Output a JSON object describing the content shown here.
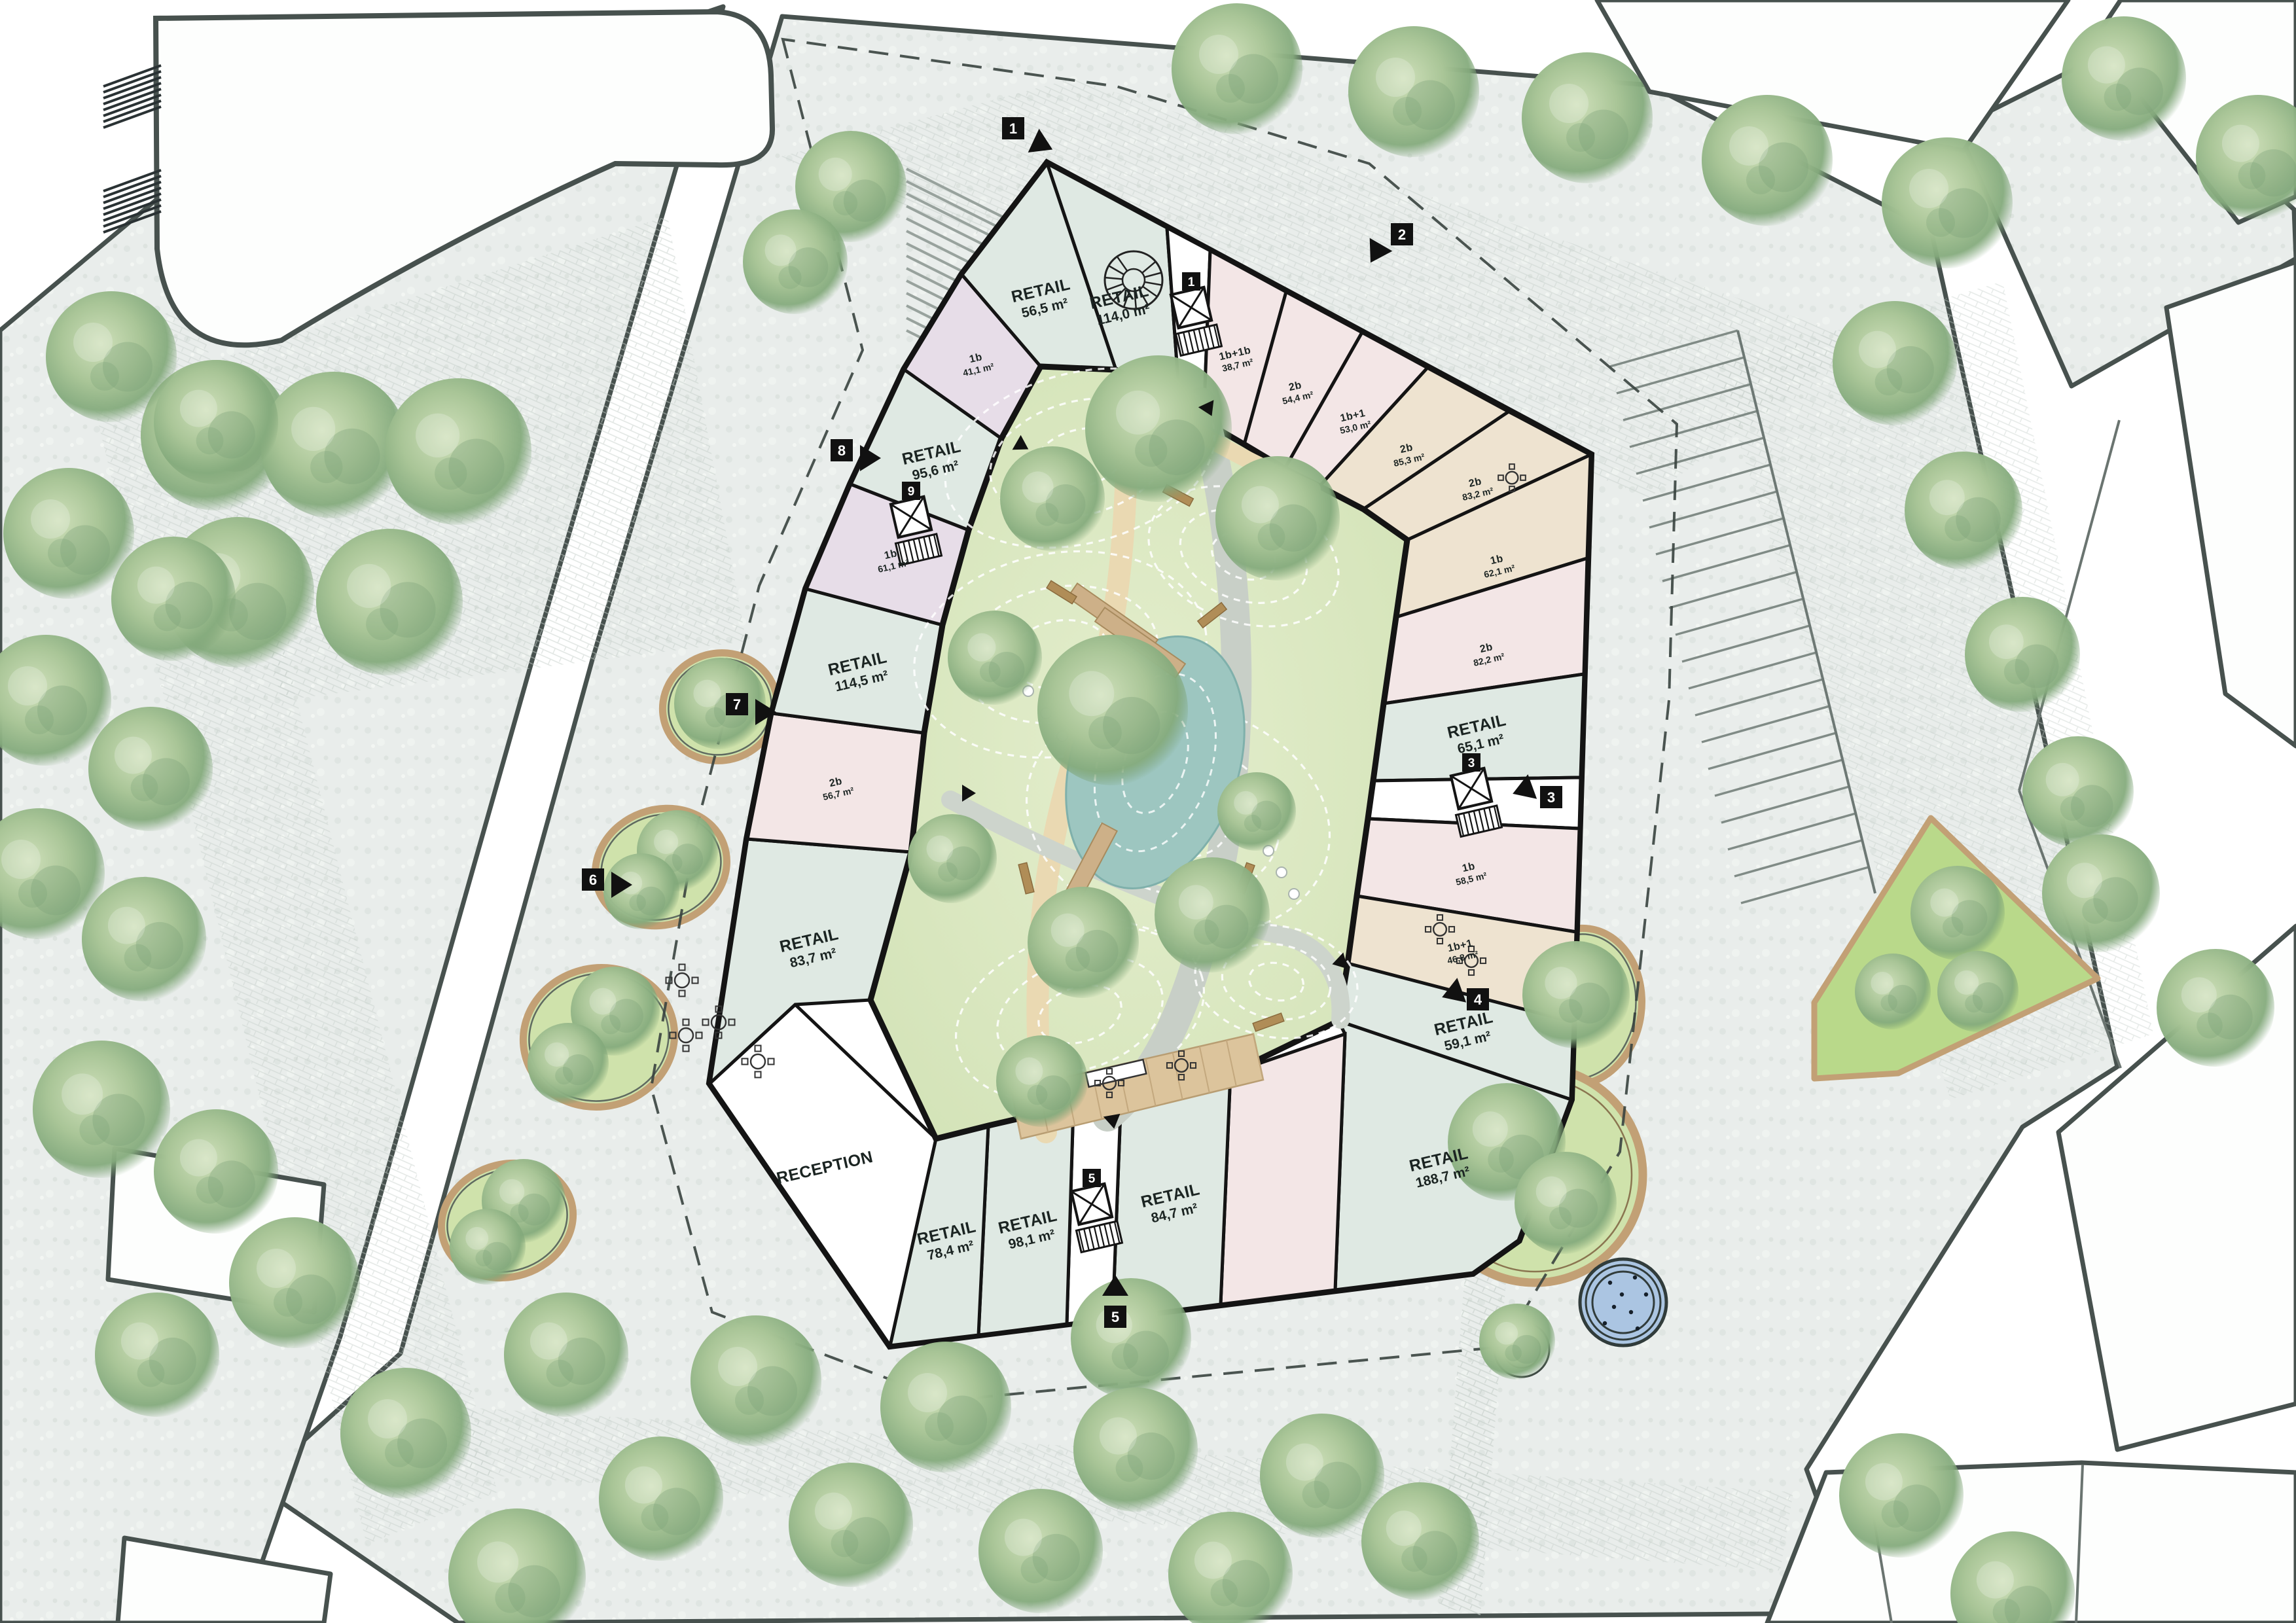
{
  "plan": {
    "type": "architectural-site-plan",
    "rooms": [
      {
        "id": "retail_nw",
        "label": "RETAIL",
        "area": "114,0 m²"
      },
      {
        "id": "retail_w56",
        "label": "RETAIL",
        "area": "56,5 m²"
      },
      {
        "id": "retail_w95",
        "label": "RETAIL",
        "area": "95,6 m²"
      },
      {
        "id": "retail_w114",
        "label": "RETAIL",
        "area": "114,5 m²"
      },
      {
        "id": "retail_w83",
        "label": "RETAIL",
        "area": "83,7 m²"
      },
      {
        "id": "reception",
        "label": "RECEPTION",
        "area": ""
      },
      {
        "id": "retail_s78",
        "label": "RETAIL",
        "area": "78,4 m²"
      },
      {
        "id": "retail_s98",
        "label": "RETAIL",
        "area": "98,1 m²"
      },
      {
        "id": "retail_s84",
        "label": "RETAIL",
        "area": "84,7 m²"
      },
      {
        "id": "retail_se",
        "label": "RETAIL",
        "area": "188,7 m²"
      },
      {
        "id": "retail_e59",
        "label": "RETAIL",
        "area": "59,1 m²"
      },
      {
        "id": "retail_e65",
        "label": "RETAIL",
        "area": "65,1 m²"
      },
      {
        "id": "apt_n38",
        "label": "1b+1b",
        "area": "38,7 m²"
      },
      {
        "id": "apt_n54",
        "label": "2b",
        "area": "54,4 m²"
      },
      {
        "id": "apt_n53",
        "label": "1b+1",
        "area": "53,0 m²"
      },
      {
        "id": "apt_n85",
        "label": "2b",
        "area": "85,3 m²"
      },
      {
        "id": "apt_ne83",
        "label": "2b",
        "area": "83,2 m²"
      },
      {
        "id": "apt_e62",
        "label": "1b",
        "area": "62,1 m²"
      },
      {
        "id": "apt_e82",
        "label": "2b",
        "area": "82,2 m²"
      },
      {
        "id": "apt_e58",
        "label": "1b",
        "area": "58,5 m²"
      },
      {
        "id": "apt_e46",
        "label": "1b+1",
        "area": "46,8 m²"
      },
      {
        "id": "apt_w56",
        "label": "2b",
        "area": "56,7 m²"
      },
      {
        "id": "apt_w61",
        "label": "1b",
        "area": "61,1 m²"
      },
      {
        "id": "apt_w41",
        "label": "1b",
        "area": "41,1 m²"
      }
    ],
    "entrance_markers": [
      {
        "number": "1"
      },
      {
        "number": "2"
      },
      {
        "number": "3"
      },
      {
        "number": "4"
      },
      {
        "number": "5"
      },
      {
        "number": "6"
      },
      {
        "number": "7"
      },
      {
        "number": "8"
      }
    ],
    "stair_cores": [
      {
        "number": "1"
      },
      {
        "number": "3"
      },
      {
        "number": "5"
      },
      {
        "number": "9"
      }
    ]
  },
  "colors": {
    "paper": "#ffffff",
    "paving": "#e9edeb",
    "paving_speckle_dark": "#dde3e0",
    "paving_speckle_light": "#f2f5f2",
    "cobble_line": "#c6cfca",
    "street_line": "#47514e",
    "thin_line": "#6a7470",
    "wall": "#141414",
    "room_mint": "#dfe9e3",
    "room_pink": "#f3e6e6",
    "room_beige": "#eee3d0",
    "room_lavender": "#e7dde8",
    "room_white": "#ffffff",
    "lawn": "#d8e6bf",
    "lawn_light": "#e4eecd",
    "park_green": "#b9d98a",
    "pond": "#9dc6c0",
    "path_beige": "#ead9b2",
    "deck_wood": "#dcc49c",
    "bench_wood": "#b08d57",
    "planter_edge": "#c2a075",
    "fountain_water": "#abc5e2",
    "fountain_ring": "#313c3b",
    "boundary": "#39423f",
    "tree_mid": "#a3c293",
    "tree_dark": "#7ba178",
    "label_ink": "#1b2422"
  }
}
